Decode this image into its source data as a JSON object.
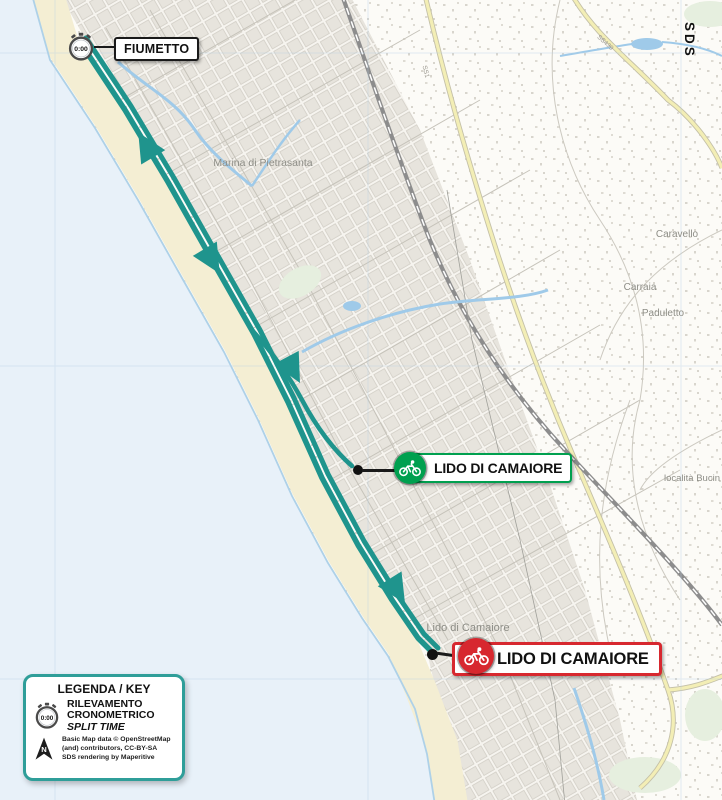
{
  "colors": {
    "route": "#1f948d",
    "sea": "#e8f1f9",
    "beach": "#f4eed3",
    "start": "#00a04f",
    "finish": "#d7282f",
    "legend": "#2f9e99",
    "label": "#8d8d86",
    "water": "#9fcae9"
  },
  "watermark": "SDS",
  "map_labels": {
    "town1": "Marina di Pietrasanta",
    "town2": "Caravello",
    "town3": "Carraia",
    "town4": "Paduletto",
    "town5": "località Bucin",
    "town6": "Lido di Camaiore",
    "road1": "SS1",
    "road2": "SS439"
  },
  "markers": {
    "split": {
      "label": "FIUMETTO",
      "time": "0:00"
    },
    "start": {
      "label": "LIDO DI CAMAIORE"
    },
    "finish": {
      "label": "LIDO DI CAMAIORE"
    }
  },
  "legend": {
    "title": "LEGENDA / KEY",
    "split_time": "0:00",
    "split_line1": "RILEVAMENTO",
    "split_line2": "CRONOMETRICO",
    "split_line3": "SPLIT TIME",
    "north": "N",
    "credit1": "Basic Map data © OpenStreetMap",
    "credit2": "(and) contributors, CC-BY-SA",
    "credit3": "SDS rendering by Maperitive"
  }
}
